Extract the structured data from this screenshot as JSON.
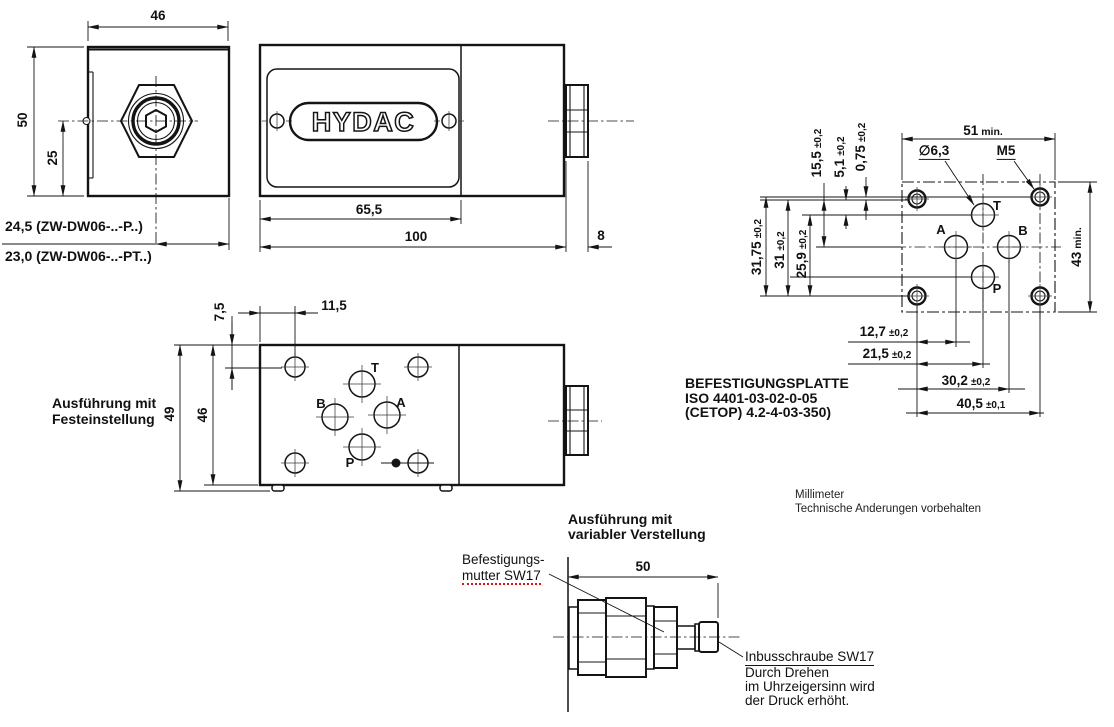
{
  "front_view": {
    "dim_width": "46",
    "dim_height": "50",
    "dim_half": "25",
    "variant_note_1": "24,5 (ZW-DW06-..-P..)",
    "variant_note_2": "23,0 (ZW-DW06-..-PT..)"
  },
  "side_view": {
    "logo": "HYDAC",
    "dim_plate_length": "65,5",
    "dim_body_length": "100",
    "dim_nut_width": "8"
  },
  "top_view": {
    "caption_1": "Ausführung mit",
    "caption_2": "Festeinstellung",
    "dim_hole_y": "7,5",
    "dim_hole_x": "11,5",
    "dim_height_total": "49",
    "dim_height_body": "46",
    "port_t": "T",
    "port_a": "A",
    "port_b": "B",
    "port_p": "P"
  },
  "mounting_plate": {
    "title_1": "BEFESTIGUNGSPLATTE",
    "title_2": "ISO 4401-03-02-0-05",
    "title_3": "(CETOP) 4.2-4-03-350)",
    "dim_width": {
      "value": "51",
      "suffix": "min."
    },
    "dim_height": {
      "value": "43",
      "suffix": "min."
    },
    "hole_dia": "∅6,3",
    "thread": "M5",
    "dims_top": [
      {
        "value": "15,5",
        "tol": "±0,2"
      },
      {
        "value": "5,1",
        "tol": "±0,2"
      },
      {
        "value": "0,75",
        "tol": "±0,2"
      }
    ],
    "dims_left": [
      {
        "value": "31,75",
        "tol": "±0,2"
      },
      {
        "value": "31",
        "tol": "±0,2"
      },
      {
        "value": "25,9",
        "tol": "±0,2"
      }
    ],
    "dims_bottom": [
      {
        "value": "12,7",
        "tol": "±0,2"
      },
      {
        "value": "21,5",
        "tol": "±0,2"
      },
      {
        "value": "30,2",
        "tol": "±0,2"
      },
      {
        "value": "40,5",
        "tol": "±0,1"
      }
    ],
    "port_t": "T",
    "port_a": "A",
    "port_b": "B",
    "port_p": "P"
  },
  "cartridge_view": {
    "caption_1": "Ausführung mit",
    "caption_2": "variabler Verstellung",
    "label_nut_1": "Befestigungs-",
    "label_nut_2": "mutter SW17",
    "dim_length": "50",
    "note_screw": "Inbusschraube SW17",
    "note_line_1": "Durch Drehen",
    "note_line_2": "im Uhrzeigersinn wird",
    "note_line_3": "der Druck erhöht."
  },
  "footer": {
    "units": "Millimeter",
    "note": "Technische Anderungen vorbehalten"
  }
}
